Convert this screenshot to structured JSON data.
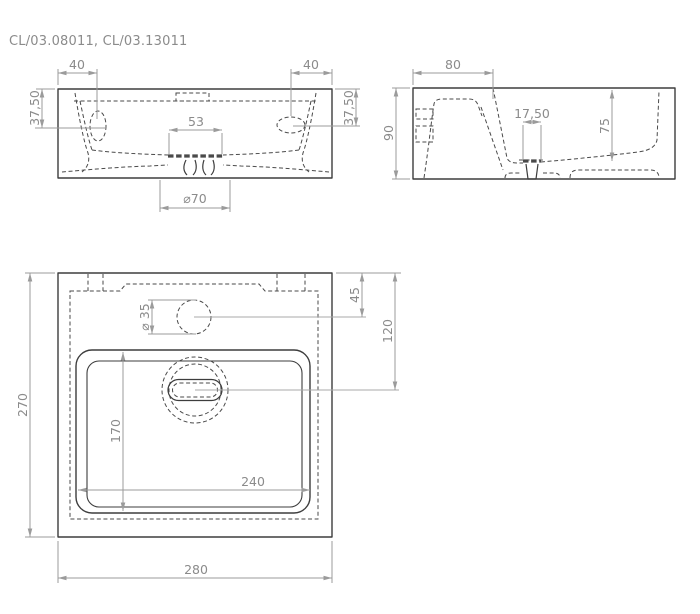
{
  "title": "CL/03.08011, CL/03.13011",
  "colors": {
    "background": "#ffffff",
    "outline": "#3d3d3d",
    "hidden_line": "#4a4a4a",
    "dimension_line": "#9b9b9b",
    "dimension_text": "#8b8b8b"
  },
  "front_view": {
    "dims": {
      "slot_offset_left": "40",
      "slot_offset_right": "40",
      "slot_drop_left": "37,50",
      "slot_drop_right": "37,50",
      "waste_slot_width": "53",
      "waste_recess_diameter": "⌀70"
    }
  },
  "side_view": {
    "dims": {
      "tap_deck_depth": "80",
      "overall_height": "90",
      "waste_width": "17,50",
      "basin_inner_height": "75"
    }
  },
  "plan_view": {
    "dims": {
      "overall_depth": "270",
      "overall_width": "280",
      "tap_hole_offset": "45",
      "waste_center_offset": "120",
      "tap_hole_diameter": "⌀ 35",
      "basin_inner_depth": "170",
      "basin_inner_width": "240"
    }
  }
}
